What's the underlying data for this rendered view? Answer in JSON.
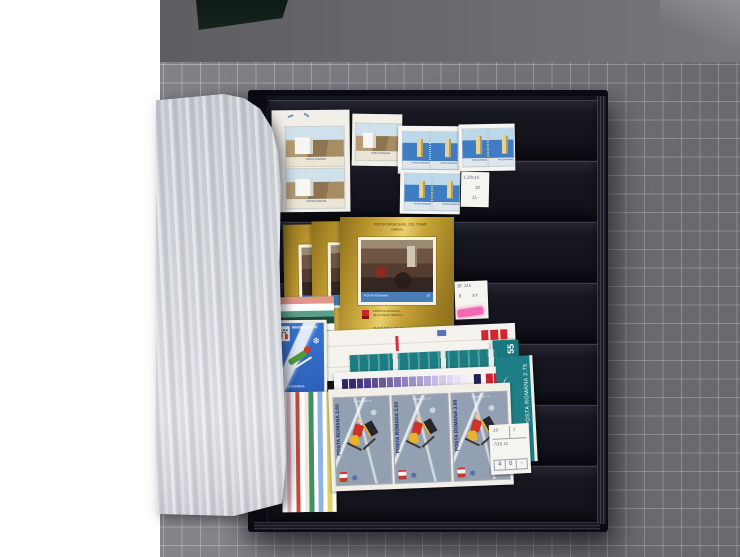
{
  "scene": {
    "title": "Open stamp stockbook with Romanian stamps on a gray cutting mat",
    "colors": {
      "mat": "#7a7a80",
      "mat_grid": "#c4c4cc",
      "desk": "#66666a",
      "book_cover": "#0b0b13",
      "book_page": "#13131c",
      "glassine_paper": "#ced2d8",
      "gold_foil": "#c7a438",
      "highlight_pink": "#f268b4"
    }
  },
  "stamps": {
    "mountain_hotel_block": {
      "country": "POSTA ROMANA"
    },
    "blue_hotel_pairs": {
      "country": "POSTA ROMANA"
    },
    "bruegel_gold_sheet": {
      "title_line1": "PIETER BRUEGHEL CEL TINAR",
      "title_line2": "( IARNA )",
      "country": "POSTA ROMANA",
      "value": "10",
      "exhibition_line1": "EXPOZITIA MONDIALA",
      "exhibition_line2": "DE FILATELIE TEMATICA",
      "footer": "THEMABELGA-BRUXELLES"
    },
    "luge_olympic": {
      "header": "INNSBRUCK '76",
      "country": "POSTA ROMANA"
    },
    "teal_value_55": {
      "value": "55",
      "country": "POSTA ROMANA"
    },
    "teal_value_275": {
      "side_text": "POSTA ROMANA 2.75"
    },
    "hockey_olympic": {
      "side_text": "POSTA ROMANA 3.60",
      "event": "INNSBRUCK '76"
    }
  },
  "price_labels": {
    "label_top": {
      "line1": "1.20x15",
      "line2": "30",
      "line3": "11,-"
    },
    "label_middle": {
      "line1": "Bl. 115",
      "line2": "8",
      "line3": "XX"
    },
    "label_bottom": {
      "row1_left": "19",
      "row1_right": "1",
      "row2": "7/16 11",
      "cells": [
        "4",
        "0",
        "-"
      ]
    }
  },
  "calibration": {
    "purple_strip": [
      "#2e2468",
      "#382a72",
      "#43357e",
      "#4f4189",
      "#5b4d94",
      "#68599f",
      "#7566aa",
      "#8273b4",
      "#8f81bf",
      "#9d8fc9",
      "#aa9dd2",
      "#b8abdb",
      "#c5bae3",
      "#d2c8ea",
      "#dfd6f0",
      "#eae3f5",
      "#f2eef8"
    ],
    "single": [
      "#232058"
    ],
    "red_squares": [
      "#cd2530",
      "#cd2530",
      "#cd2530",
      "#cd2530"
    ],
    "red_squares_top": [
      "#d2262e",
      "#d2262e",
      "#d2262e"
    ],
    "stripes_horizontal": [
      "#e2968a",
      "#ffffff",
      "#58a08a",
      "#1e4a3c",
      "#ffffff"
    ],
    "stripes_vertical": [
      "#ffffff",
      "#e9b7c4",
      "#ffffff",
      "#c84a3e",
      "#ffffff",
      "#efe9da",
      "#3f8f63",
      "#ffffff",
      "#8fb6e2",
      "#ffffff",
      "#e2d264",
      "#ffffff"
    ]
  }
}
